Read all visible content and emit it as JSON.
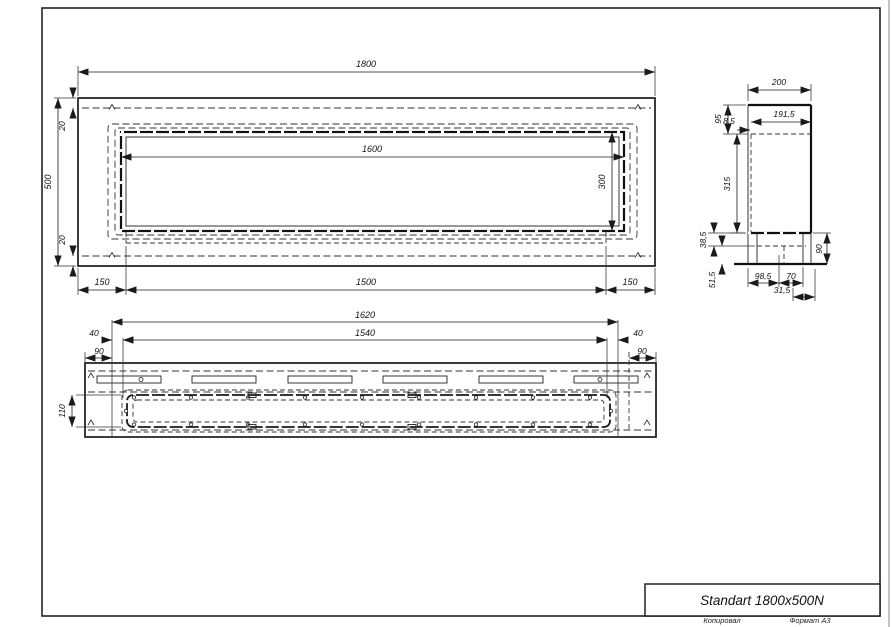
{
  "title_block": {
    "product": "Standart 1800x500N"
  },
  "footer": {
    "copied_by": "Копировал",
    "format": "Формат А3"
  },
  "dims": {
    "top": {
      "overall_width": "1800",
      "overall_depth": "500",
      "edge_top": "20",
      "edge_bottom": "20",
      "opening_width": "1600",
      "opening_depth": "300",
      "offset_left": "150",
      "burner_length": "1500",
      "offset_right": "150"
    },
    "side": {
      "width": "200",
      "inner_width": "191,5",
      "lip": "8,5",
      "top_inset": "95",
      "body": "315",
      "d38": "38,5",
      "d51": "51,5",
      "d98": "98,5",
      "d70": "70",
      "d31": "31,5",
      "d90": "90"
    },
    "bottom": {
      "outer_span": "1620",
      "inner_span": "1540",
      "left_40": "40",
      "left_90": "90",
      "right_40": "40",
      "right_90": "90",
      "tray_depth": "110"
    }
  }
}
